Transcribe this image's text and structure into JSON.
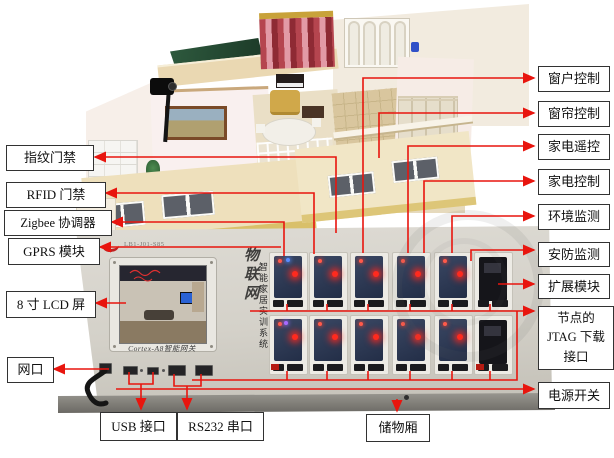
{
  "callouts": {
    "fingerprint": "指纹门禁",
    "rfid": "RFID 门禁",
    "zigbee": "Zigbee 协调器",
    "gprs": "GPRS 模块",
    "lcd": "8 寸 LCD 屏",
    "lan": "网口",
    "usb": "USB 接口",
    "rs232": "RS232 串口",
    "storage": "储物厢",
    "window": "窗户控制",
    "curtain": "窗帘控制",
    "remote": "家电遥控",
    "appliance": "家电控制",
    "env": "环境监测",
    "security": "安防监测",
    "expansion": "扩展模块",
    "jtag": "节点的 JTAG 下载接口",
    "power": "电源开关"
  },
  "panel": {
    "model_code": "LB1-J01-S85",
    "gateway_label": "Cortex-A8智能网关",
    "brand_vertical": "物联网",
    "system_vertical": "智能家居实训系统"
  },
  "colors": {
    "annotation_red": "#e8150e",
    "panel_gray": "#d6d3cb",
    "pcb_blue": "#2e3a55",
    "led_red": "#ff2a1e"
  }
}
